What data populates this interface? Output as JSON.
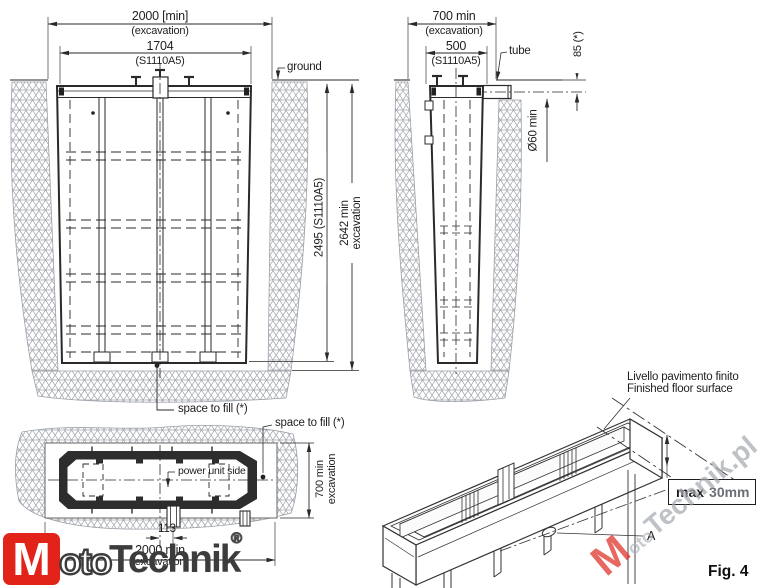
{
  "front": {
    "dim_w_exc": "2000 [min]",
    "dim_w_exc_sub": "(excavation)",
    "dim_w": "1704",
    "dim_w_sub": "(S1110A5)",
    "ground": "ground",
    "dim_h": "2495 (S1110A5)",
    "dim_h_exc_1": "2642 min",
    "dim_h_exc_2": "excavation",
    "space_to_fill": "space to fill (*)"
  },
  "side": {
    "dim_w_exc": "700 min",
    "dim_w_exc_sub": "(excavation)",
    "dim_w": "500",
    "dim_w_sub": "(S1110A5)",
    "tube": "tube",
    "dim_tube_offset": "85 (*)",
    "dim_tube_depth": "Ø60 min"
  },
  "plan": {
    "space_to_fill": "space to fill (*)",
    "power_unit": "power unit side",
    "dim_d_1": "700 min",
    "dim_d_2": "excavation",
    "dim_tube": "113",
    "dim_w": "2000 min",
    "dim_w_sub": "(excavation)"
  },
  "iso": {
    "floor_it": "Livello pavimento finito",
    "floor_en": "Finished floor surface",
    "max_label": "max",
    "max_value": "30mm",
    "detail": "A"
  },
  "figure_label": "Fig. 4",
  "logo": {
    "m": "M",
    "oto": "oto",
    "technik": "Technik",
    "reg": "®"
  },
  "watermark": {
    "m": "M",
    "oto": "oto",
    "rest": "Technik.pl"
  },
  "colors": {
    "line": "#2a2a2a",
    "hatch": "#a0a5ab",
    "logo_red": "#e2231a",
    "watermark_gray": "#a2a7af"
  }
}
